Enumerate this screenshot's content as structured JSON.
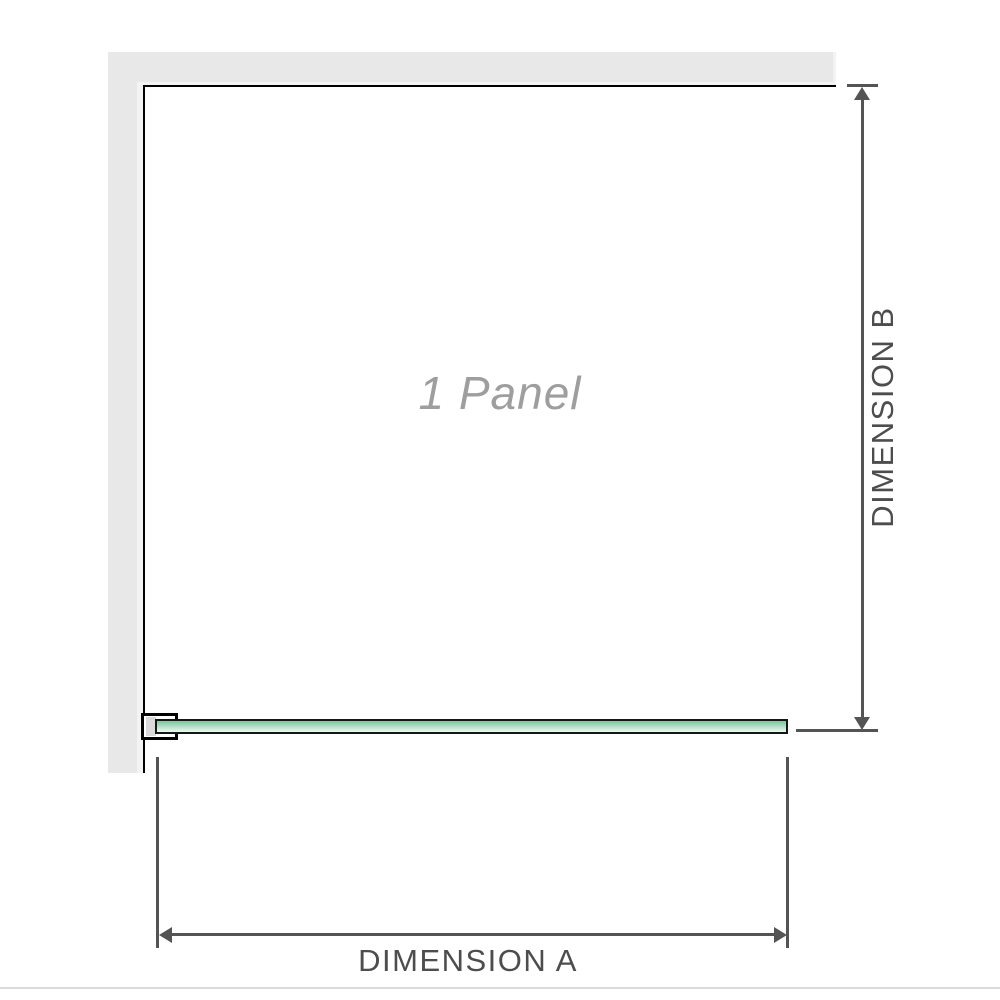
{
  "diagram": {
    "panel_label": "1 Panel",
    "dimension_a_label": "DIMENSION A",
    "dimension_b_label": "DIMENSION B"
  },
  "colors": {
    "wall_gray": "#e8e8e8",
    "wall_inner_gray": "#f3f3f3",
    "frame_black": "#000000",
    "dimension_gray": "#545454",
    "label_gray": "#4d4d4d",
    "panel_label_gray": "#9e9e9e",
    "glass_green_top": "#84c9a4",
    "glass_green_bottom": "#e9f6ee",
    "glass_border": "#161616",
    "bracket_pad_gray": "#d9d9d9",
    "divider_gray": "#dadada"
  }
}
